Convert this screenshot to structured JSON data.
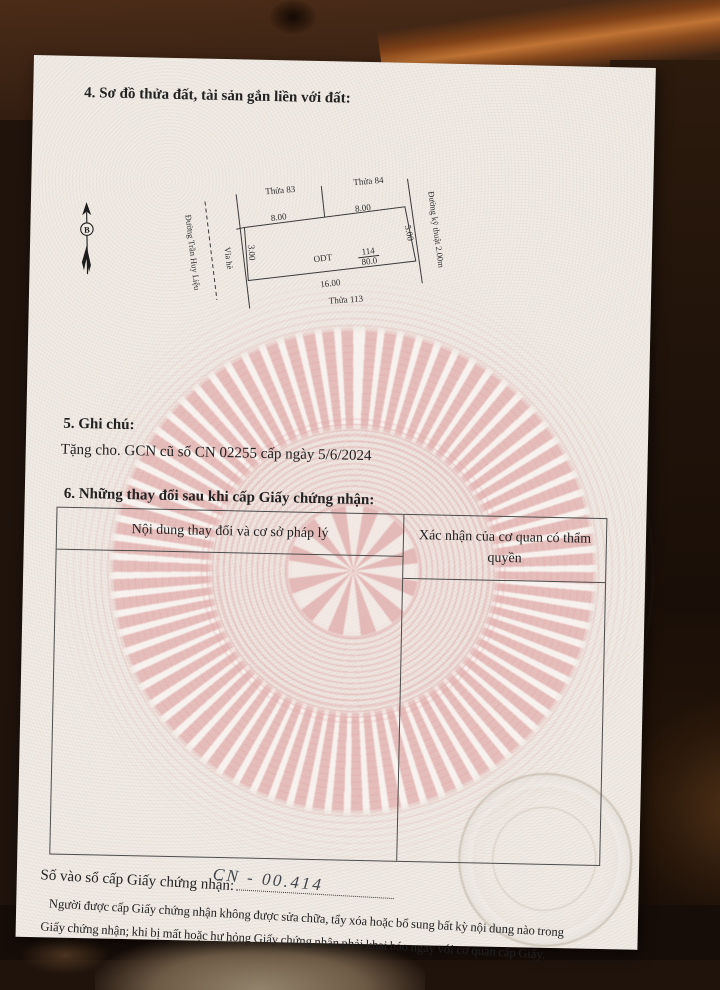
{
  "page": {
    "section4": {
      "heading": "4. Sơ đồ thửa đất, tài sản gắn liền với đất:"
    },
    "diagram": {
      "north_label": "B",
      "street_left": "Đường Trần Huy Liệu",
      "sidewalk": "Vỉa hè",
      "street_right": "Đường kỹ thuật 2.00m",
      "plot_top_left": "Thửa 83",
      "plot_top_right": "Thửa 84",
      "plot_bottom": "Thửa 113",
      "len_top_left": "8.00",
      "len_top_right": "8.00",
      "len_right": "5.00",
      "len_left": "3.00",
      "len_bottom": "16.00",
      "parcel_number": "114",
      "land_use_code": "ODT",
      "area": "80.0"
    },
    "section5": {
      "heading": "5. Ghi chú:",
      "note": "Tặng cho. GCN cũ số CN 02255 cấp ngày 5/6/2024"
    },
    "section6": {
      "heading": "6. Những thay đổi sau khi cấp Giấy chứng nhận:",
      "table": {
        "col1": "Nội dung thay đổi và cơ sở pháp lý",
        "col2": "Xác nhận của cơ quan có thẩm quyền"
      }
    },
    "footer": {
      "registry_label": "Số vào sổ cấp Giấy chứng nhận:",
      "registry_value": "CN - 00.414",
      "notice_line1": "Người được cấp Giấy chứng nhận không được sửa chữa, tẩy xóa hoặc bổ sung bất kỳ nội dung nào trong",
      "notice_line2": "Giấy chứng nhận; khi bị mất hoặc hư hỏng Giấy chứng nhận phải khai báo ngay với cơ quan cấp Giấy."
    }
  },
  "colors": {
    "wood_dark": "#2a1810",
    "wood_mid": "#5d3a22",
    "wood_streak": "#c07434",
    "paper": "#f1ebe5",
    "pattern_pink": "#e0a4a4",
    "ink": "#222222",
    "handwriting_ink": "#41464c",
    "table_line": "#4c4c4c"
  }
}
